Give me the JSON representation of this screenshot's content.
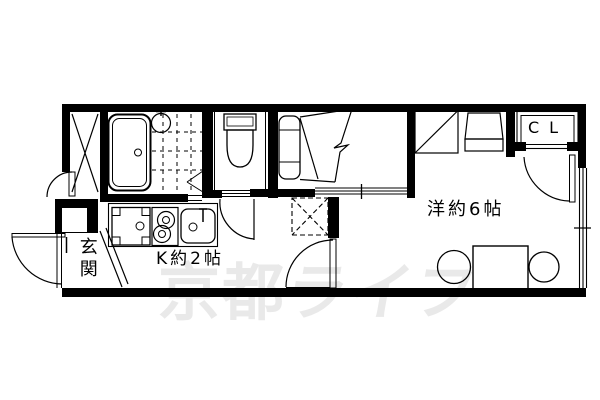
{
  "plan": {
    "title": "apartment-floor-plan",
    "labels": {
      "entrance": "玄関",
      "kitchen": "K約2帖",
      "room": "洋約6帖",
      "closet": "CL"
    },
    "watermark": {
      "text": "京都ライフ",
      "part1": "京都",
      "part2": "ライフ",
      "color": "#e9e9e9"
    },
    "colors": {
      "wall": "#000000",
      "floor": "#ffffff",
      "line": "#000000"
    },
    "fixtures": {
      "bathtub": "rounded-rect-tub-with-drain",
      "bath_sink": "circle-basin-with-tap",
      "bath_tile_floor": "dashed-grid",
      "bath_folding_door": "wedge-lines",
      "toilet": "tank-and-bowl",
      "trunk_storage": "x-cross-strip",
      "bed": "headboard-with-break-line",
      "washer_pan": "square-with-corner-blocks",
      "stove": "two-burner-circles",
      "kitchen_sink": "rounded-basin-with-faucet",
      "storage_hatch": "dashed-x-square",
      "washing_machine_space": "square-with-diagonal",
      "utility_unit": "trapezoid-block",
      "dining_table": "rectangle",
      "chairs": "two-circles",
      "entrance_door": "swing-arc",
      "trunk_door": "swing-arc",
      "toilet_door": "swing-arc",
      "room_door": "swing-arc",
      "closet_door": "swing-arc",
      "window_right": "triple-line-sliding",
      "bed_partition": "triple-line-sliding"
    }
  }
}
